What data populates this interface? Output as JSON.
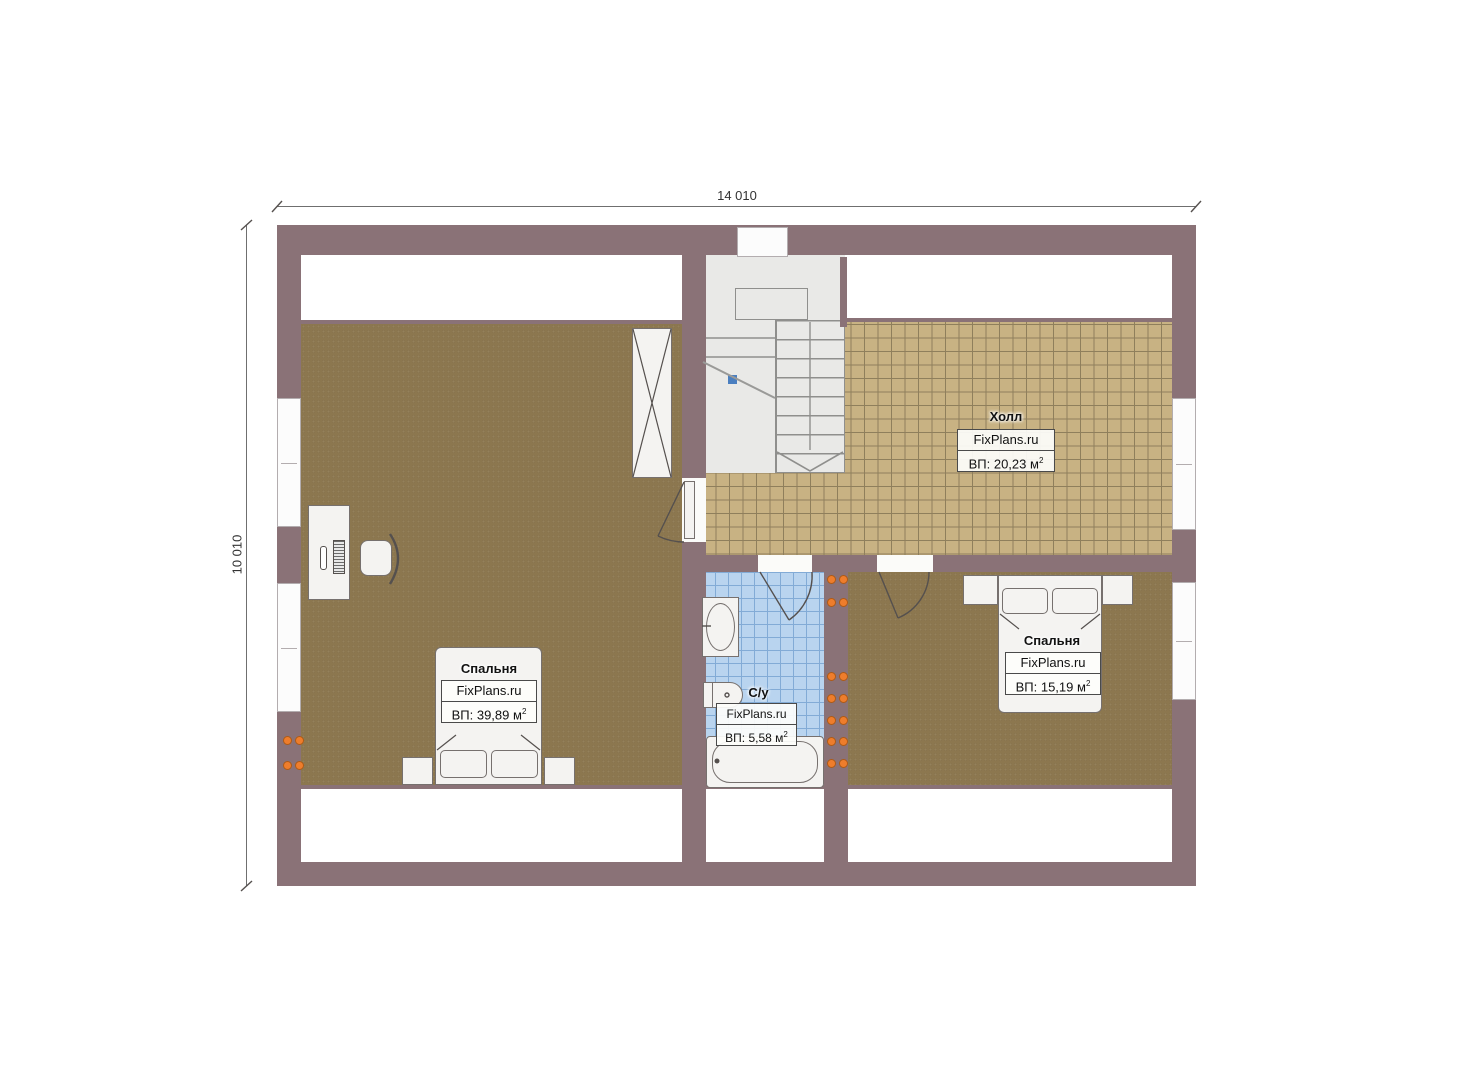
{
  "dimensions": {
    "width": "14 010",
    "height": "10 010"
  },
  "rooms": [
    {
      "name": "Спальня",
      "brand": "FixPlans.ru",
      "area": "ВП: 39,89 м",
      "sup": "2"
    },
    {
      "name": "Холл",
      "brand": "FixPlans.ru",
      "area": "ВП: 20,23 м",
      "sup": "2"
    },
    {
      "name": "С/у",
      "brand": "FixPlans.ru",
      "area": "ВП: 5,58 м",
      "sup": "2"
    },
    {
      "name": "Спальня",
      "brand": "FixPlans.ru",
      "area": "ВП: 15,19 м",
      "sup": "2"
    }
  ],
  "colors": {
    "wall": "#8a7277",
    "wood_floor": "#8c774f",
    "hall_tile": "#c8b283",
    "bath_tile": "#b9d4ef",
    "radiator": "#ee7d2c",
    "stair_marker": "#4a7fc0"
  }
}
